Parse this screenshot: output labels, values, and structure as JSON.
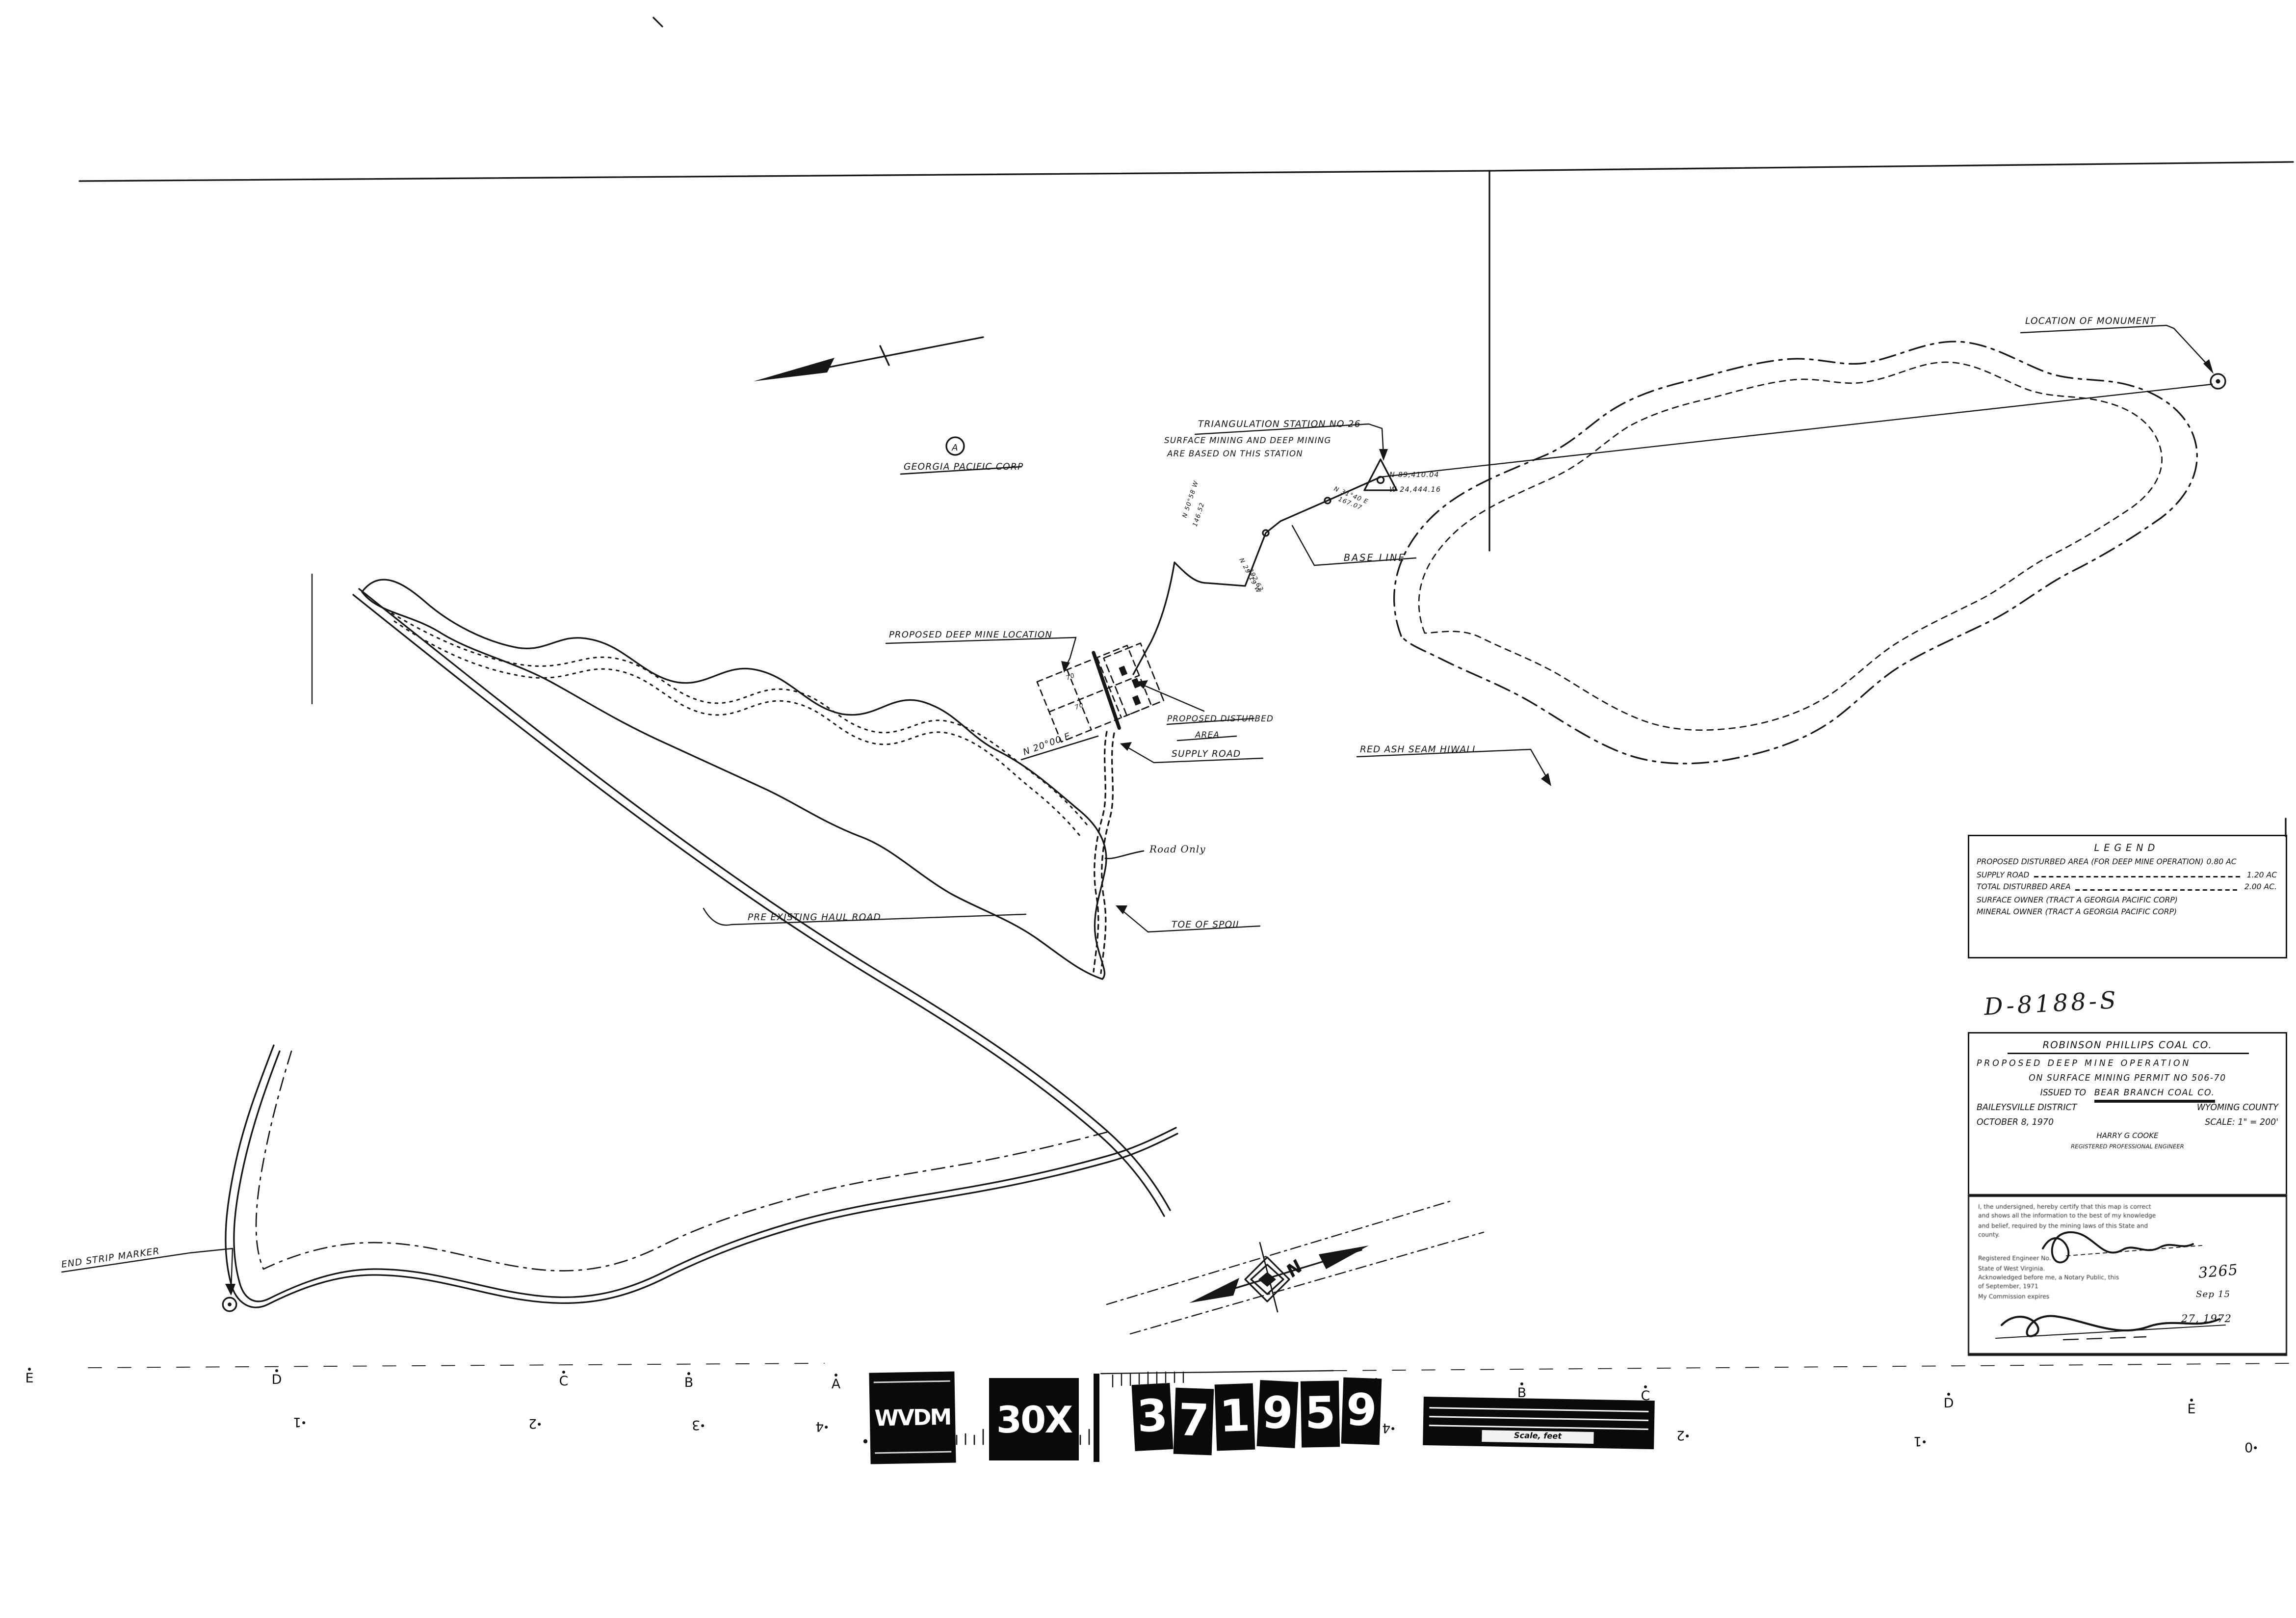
{
  "page": {
    "background": "#ffffff",
    "ink": "#161616"
  },
  "map": {
    "labels": {
      "location_of_monument": "LOCATION OF MONUMENT",
      "triangulation_station": "TRIANGULATION STATION NO 26",
      "triangulation_note_line1": "SURFACE MINING AND DEEP MINING",
      "triangulation_note_line2": "ARE BASED ON THIS STATION",
      "station_coordinate_north": "N 89,410.04",
      "station_coordinate_west": "W 24,444.16",
      "tract_letter": "A",
      "owner_name": "GEORGIA PACIFIC CORP",
      "base_line": "BASE LINE",
      "proposed_deep_mine_location": "PROPOSED DEEP MINE LOCATION",
      "proposed_disturbed_area_line1": "PROPOSED DISTURBED",
      "proposed_disturbed_area_line2": "AREA",
      "red_ash_seam_hiwall": "RED ASH SEAM HIWALL",
      "supply_road": "SUPPLY ROAD",
      "road_only": "Road Only",
      "toe_of_spoil": "TOE OF SPOIL",
      "pre_existing_haul_road": "PRE EXISTING HAUL ROAD",
      "end_strip_marker": "END STRIP MARKER",
      "bearing_main": "N 20°00 E",
      "bearing_1": "N 29°19 W",
      "distance_1": "392.63",
      "bearing_2": "N 31°40 E",
      "distance_2": "167.07",
      "bearing_3": "N 50°58 W",
      "distance_3": "146.52",
      "grid_cell_label": "70",
      "north_letter": "N"
    }
  },
  "legend": {
    "title": "LEGEND",
    "rows": [
      {
        "label": "PROPOSED DISTURBED AREA (FOR DEEP MINE OPERATION)",
        "value": "0.80 AC"
      },
      {
        "label": "SUPPLY ROAD",
        "value": "1.20 AC"
      },
      {
        "label": "TOTAL DISTURBED AREA",
        "value": "2.00 AC."
      },
      {
        "label": "SURFACE OWNER (TRACT A GEORGIA PACIFIC CORP)",
        "value": ""
      },
      {
        "label": "MINERAL OWNER (TRACT A GEORGIA PACIFIC CORP)",
        "value": ""
      }
    ]
  },
  "plate_number": "D-8188-S",
  "title_block": {
    "company": "ROBINSON PHILLIPS COAL CO.",
    "line1": "PROPOSED DEEP MINE OPERATION",
    "line2": "ON SURFACE MINING PERMIT NO 506-70",
    "issued_prefix": "ISSUED TO",
    "issued_to": "BEAR BRANCH COAL CO.",
    "district": "BAILEYSVILLE DISTRICT",
    "county": "WYOMING COUNTY",
    "date": "OCTOBER 8, 1970",
    "scale": "SCALE: 1\" = 200'",
    "engineer": "HARRY G COOKE",
    "engineer_title": "REGISTERED PROFESSIONAL ENGINEER"
  },
  "certification": {
    "line1": "I, the undersigned, hereby certify that this map is correct",
    "line2": "and shows all the information to the best of my knowledge",
    "line3": "and belief, required by the mining laws of this State and",
    "line4": "county.",
    "engineer_no_label": "Registered Engineer No.",
    "engineer_no": "3265",
    "state_line": "State of West Virginia.",
    "notary_line1": "Acknowledged before me, a Notary Public, this",
    "notary_day": "Sep 15",
    "notary_line2": "of September, 1971",
    "commission_line": "My Commission expires",
    "commission_date": "27, 1972"
  },
  "film_strip": {
    "agency": "WVDM",
    "magnification": "30X",
    "reel_digits": [
      "3",
      "7",
      "1",
      "9",
      "5",
      "9"
    ],
    "alpha_mark": "α",
    "scale_bar_label": "Scale, feet",
    "index_letters_left": [
      "E",
      "D",
      "C",
      "B",
      "A"
    ],
    "index_numbers_left": [
      "1",
      "2",
      "3",
      "4"
    ],
    "index_letters_right": [
      "A",
      "B",
      "C",
      "D",
      "E"
    ],
    "index_numbers_right": [
      "4",
      "3",
      "2",
      "1",
      "0"
    ]
  }
}
